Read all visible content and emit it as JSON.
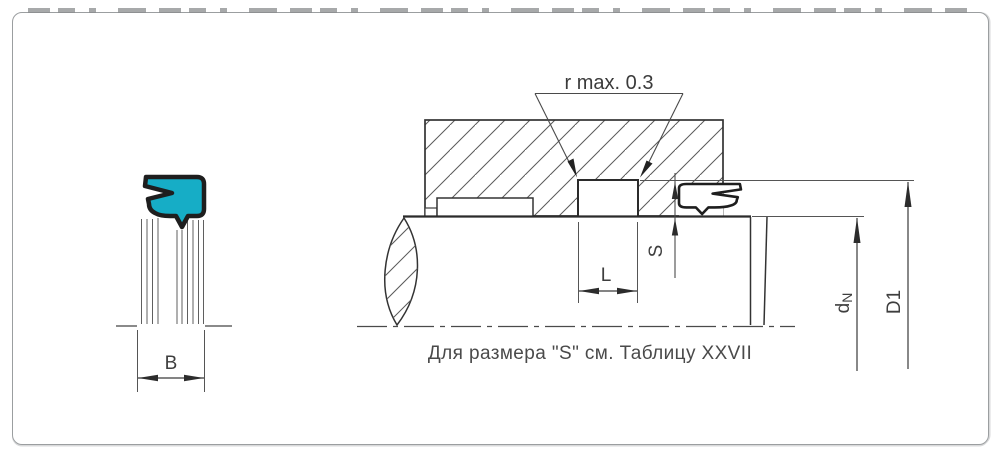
{
  "drawing": {
    "callout_r": "r  max. 0.3",
    "dims": {
      "B": "B",
      "L": "L",
      "S": "S",
      "dN_base": "d",
      "dN_sub": "N",
      "D1": "D1"
    },
    "note": "Для размера \"S\" см. Таблицу XXVII",
    "colors": {
      "seal_fill": "#16adc6",
      "outline": "#1e1e1e",
      "line": "#333333",
      "thin_line": "#555555",
      "label": "#3e3e3e",
      "border": "#9b9ea0"
    }
  }
}
